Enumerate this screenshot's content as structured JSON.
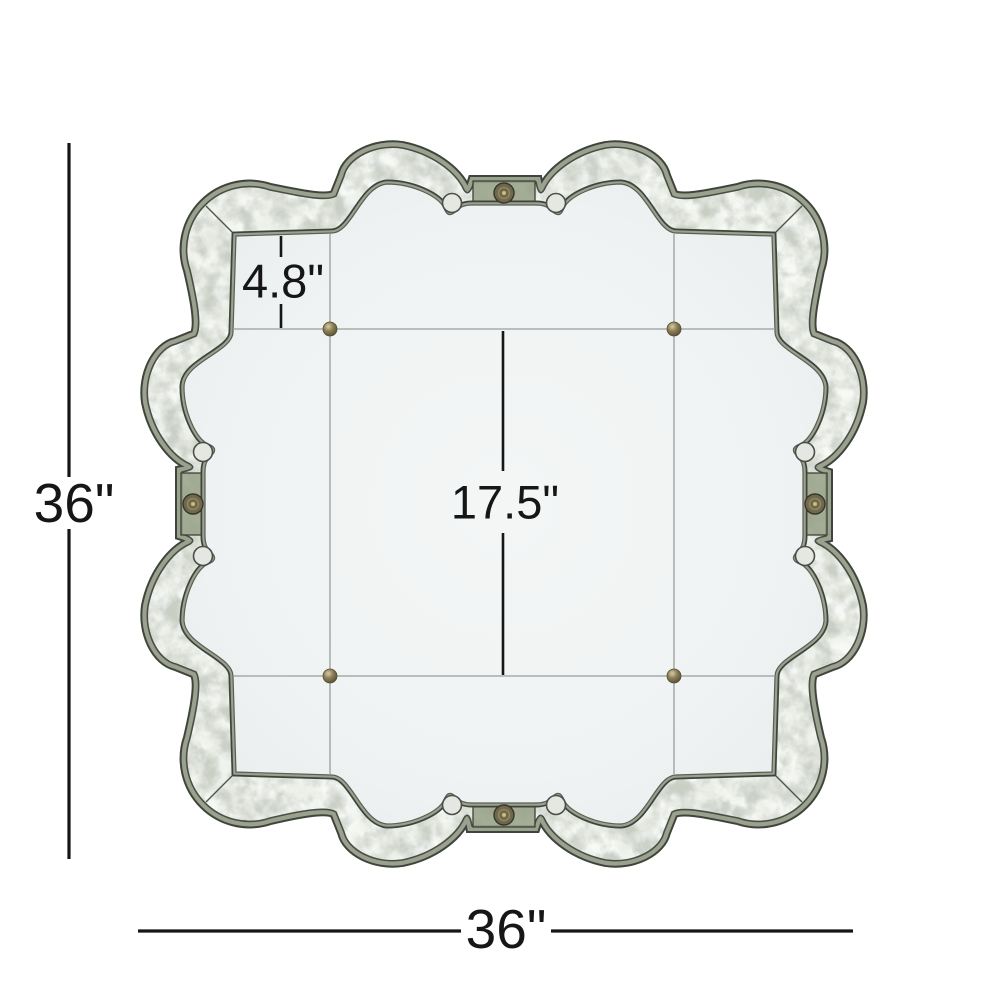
{
  "diagram": {
    "alt": "Antiqued silver scalloped quatrefoil wall mirror with dimension annotations",
    "labels": {
      "height": "36\"",
      "width": "36\"",
      "center_panel": "17.5\"",
      "border_panel": "4.8\""
    },
    "colors": {
      "background": "#ffffff",
      "dimension_line": "#161616",
      "frame_band": "#cdd2ca",
      "trim_green": "#9aa18e",
      "trim_dark": "#40453c",
      "strap_green": "#97a186",
      "glass": "#f1f4f4",
      "panel_seam": "#989e9d",
      "brass_bead": "#8d8058",
      "rosette_bronze": "#6f684c"
    }
  }
}
